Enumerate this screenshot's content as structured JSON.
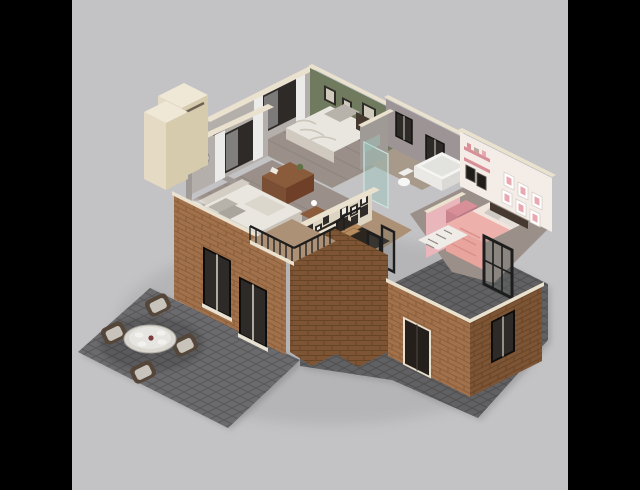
{
  "meta": {
    "description": "3D isometric cutaway render of a house upper floor plan with furnished rooms, brick facade and outdoor patio",
    "canvas": {
      "width": 640,
      "height": 490
    },
    "letterbox": {
      "left_bar_width": 72,
      "right_bar_width": 72
    }
  },
  "palette": {
    "letterbox": "#000000",
    "backdrop": "#c3c3c5",
    "ambient_shadow": "rgba(0,0,0,0.07)",
    "trim_cream": "#eae2cf",
    "chimney_top": "#efe8d6",
    "chimney_left": "#e5dbc5",
    "chimney_right": "#d7cbad",
    "wall_gray": "#b4afab",
    "wall_gray_dark": "#a09a96",
    "wall_green": "#6f7a5e",
    "wall_bath": "#9c9495",
    "wall_pink_panel": "#e9b7bb",
    "wall_white_pink": "#f4ece6",
    "pink_dark": "#d98f98",
    "window_dark": "#2e2a27",
    "curtain_white": "#ebebe9",
    "floor_wood_gray": "#9a9089",
    "floor_wood_warm": "#ac9176",
    "floor_bath": "#a89a8b",
    "bed_white": "#e9e6df",
    "bed_gray": "#b7b2aa",
    "bed_pink": "#e9a49e",
    "headboard_dark": "#46392f",
    "wood_furniture": "#8a5c3b",
    "stair_wood": "#b68c5e",
    "metal_black": "#1d1d1d",
    "glass_teal": "rgba(157,197,189,0.45)",
    "glass_dark": "rgba(90,100,95,0.25)",
    "brick_light": "#a0714a",
    "brick_dark": "#7d5434",
    "mortar_light": "#8a5c3a",
    "mortar_dark": "#664426",
    "paving": "#6b6a6c",
    "paving_dark": "#616062",
    "table_glass": "#dad7d1",
    "wicker": "#55463a",
    "cushion": "#c9c4bb",
    "plate": "#f2f1ee",
    "lamp_glow": "#ffffff",
    "frame_dark": "#2f2b28",
    "frame_pink": "#e8a8b0",
    "rug_white": "#efece8"
  },
  "scene": {
    "style": "isometric 3D dollhouse floor plan render",
    "rooms": [
      {
        "id": "master-bedroom",
        "name": "Master bedroom",
        "wall_color_key": "wall_gray",
        "furnishings": [
          "double bed with white duvet and gray pillows",
          "upholstered headboard",
          "wood dresser with plant",
          "nightstand with lamp",
          "two glowing floor lamps",
          "curtained window",
          "starburst wall clock"
        ]
      },
      {
        "id": "green-bedroom",
        "name": "Bedroom with olive-green wall",
        "wall_color_key": "wall_green",
        "furnishings": [
          "double bed with rumpled white duvet",
          "dark wood headboard",
          "nightstand with white lamp",
          "three dark picture frames",
          "curtained window"
        ]
      },
      {
        "id": "bathroom",
        "name": "Bathroom",
        "wall_color_key": "wall_bath",
        "furnishings": [
          "white bathtub",
          "toilet",
          "glass shower partition",
          "two dark windows"
        ]
      },
      {
        "id": "pink-bedroom",
        "name": "Pink kids bedroom",
        "wall_color_key": "wall_white_pink",
        "furnishings": [
          "bed with pink duvet and patterned pillows",
          "pink vanity with mirrors",
          "pink wall shelves",
          "six pink picture frames",
          "white patterned rug",
          "black metal glass partition"
        ]
      },
      {
        "id": "stair-hall",
        "name": "Stair hall",
        "wall_color_key": "trim_cream",
        "furnishings": [
          "wooden staircase of eight treads",
          "black metal handrail",
          "gallery wall of small frames",
          "black framed glass doors"
        ]
      }
    ],
    "exterior": {
      "facade": "tan brick lower floor",
      "features": [
        "cream chimney with two stacked volumes",
        "balcony with black metal railing",
        "two tall facade windows with white sills",
        "recessed entry door with cream trim",
        "side window in dark glass"
      ]
    },
    "patio": {
      "paving": "dark gray cobblestone slabs, left diamond patio and right terrace",
      "furnishings": [
        "round glass dining table",
        "four wicker chairs with light cushions",
        "four white place settings"
      ]
    },
    "counts": {
      "pink_frames": 6,
      "gallery_frames": 14,
      "stair_treads": 8,
      "facade_windows": 2,
      "patio_chairs": 4,
      "plates": 4
    }
  }
}
